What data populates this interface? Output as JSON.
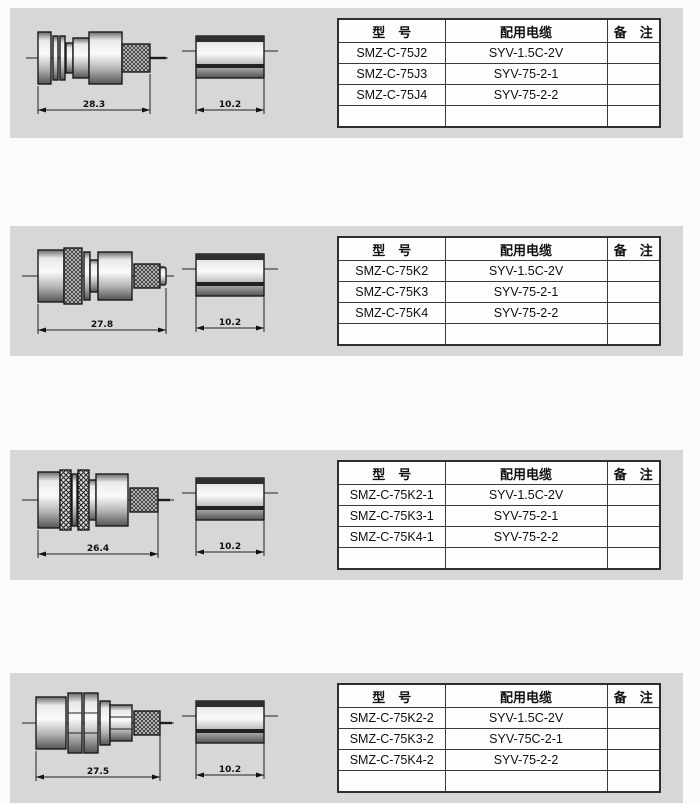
{
  "colors": {
    "page_bg": "#fbfbfb",
    "panel_bg": "#d7d7d7",
    "line": "#1b1b1b",
    "table_border": "#3a3a3a"
  },
  "table_header": {
    "model": "型　号",
    "cable": "配用电缆",
    "remark": "备　注"
  },
  "sections": [
    {
      "connector_dim": "28.3",
      "sleeve_dim": "10.2",
      "rows": [
        {
          "model": "SMZ-C-75J2",
          "cable": "SYV-1.5C-2V",
          "remark": ""
        },
        {
          "model": "SMZ-C-75J3",
          "cable": "SYV-75-2-1",
          "remark": ""
        },
        {
          "model": "SMZ-C-75J4",
          "cable": "SYV-75-2-2",
          "remark": ""
        },
        {
          "model": "",
          "cable": "",
          "remark": ""
        }
      ]
    },
    {
      "connector_dim": "27.8",
      "sleeve_dim": "10.2",
      "rows": [
        {
          "model": "SMZ-C-75K2",
          "cable": "SYV-1.5C-2V",
          "remark": ""
        },
        {
          "model": "SMZ-C-75K3",
          "cable": "SYV-75-2-1",
          "remark": ""
        },
        {
          "model": "SMZ-C-75K4",
          "cable": "SYV-75-2-2",
          "remark": ""
        },
        {
          "model": "",
          "cable": "",
          "remark": ""
        }
      ]
    },
    {
      "connector_dim": "26.4",
      "sleeve_dim": "10.2",
      "rows": [
        {
          "model": "SMZ-C-75K2-1",
          "cable": "SYV-1.5C-2V",
          "remark": ""
        },
        {
          "model": "SMZ-C-75K3-1",
          "cable": "SYV-75-2-1",
          "remark": ""
        },
        {
          "model": "SMZ-C-75K4-1",
          "cable": "SYV-75-2-2",
          "remark": ""
        },
        {
          "model": "",
          "cable": "",
          "remark": ""
        }
      ]
    },
    {
      "connector_dim": "27.5",
      "sleeve_dim": "10.2",
      "rows": [
        {
          "model": "SMZ-C-75K2-2",
          "cable": "SYV-1.5C-2V",
          "remark": ""
        },
        {
          "model": "SMZ-C-75K3-2",
          "cable": "SYV-75C-2-1",
          "remark": ""
        },
        {
          "model": "SMZ-C-75K4-2",
          "cable": "SYV-75-2-2",
          "remark": ""
        },
        {
          "model": "",
          "cable": "",
          "remark": ""
        }
      ]
    }
  ]
}
